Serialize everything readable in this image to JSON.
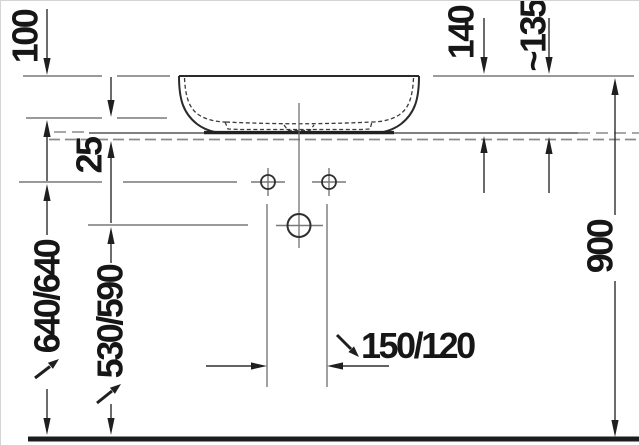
{
  "diagram": {
    "type": "technical-installation-drawing",
    "subject": "countertop washbasin, side elevation with mounting dimensions",
    "background": "#ffffff",
    "ink_color": "#2a2a2a",
    "construction_color": "#787878",
    "labels": {
      "bowl_height": "100",
      "counter_offset": "25",
      "rim_to_counter": "140",
      "rim_to_mounting": "~135",
      "supply_height": "640/640",
      "drain_height": "530/590",
      "drain_offset": "150/120",
      "rim_floor_height": "900"
    }
  }
}
